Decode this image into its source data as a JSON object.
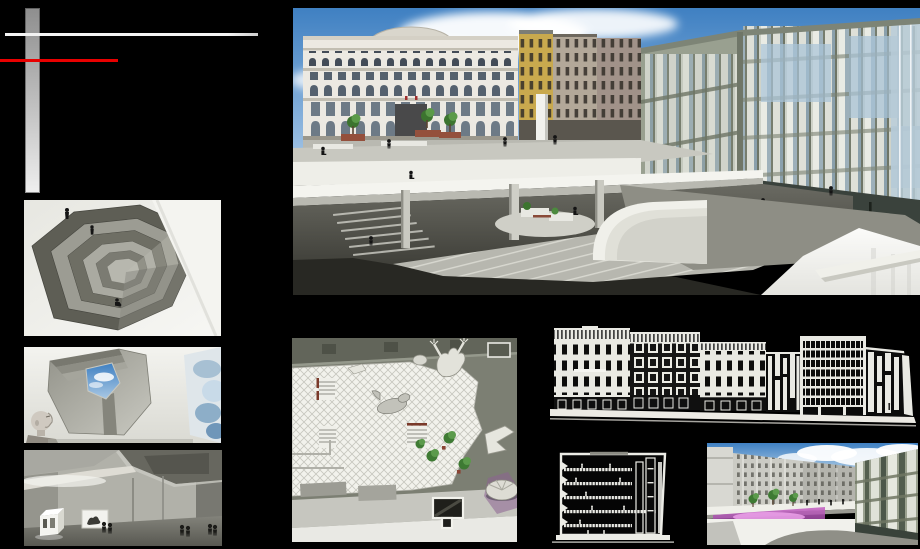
{
  "board": {
    "name": "architecture-portfolio-board"
  },
  "colors": {
    "page-bg": "#000000",
    "accent-red": "#e80000",
    "line-white": "#f4f4f4",
    "bar-gray-top": "#8e8e8e",
    "bar-gray-bottom": "#efefef",
    "sky-top": "#3f80c2",
    "sky-bottom": "#a6c6e6",
    "plan-olive": "#7c7f73",
    "glow-magenta": "#c55fc3",
    "drawing-white": "#ecece6"
  },
  "panels": {
    "main_render": {
      "name": "plaza-panorama-rendering"
    },
    "ramp_view": {
      "name": "spiral-ramp-interior-rendering"
    },
    "skylight_view": {
      "name": "skylight-interior-rendering"
    },
    "gallery_view": {
      "name": "gallery-interior-rendering"
    },
    "site_plan": {
      "name": "roof-plan-drawing"
    },
    "street_elevation": {
      "name": "street-elevation-drawing"
    },
    "building_section": {
      "name": "building-section-drawing"
    },
    "plaza_render_2": {
      "name": "plaza-deck-rendering"
    }
  }
}
